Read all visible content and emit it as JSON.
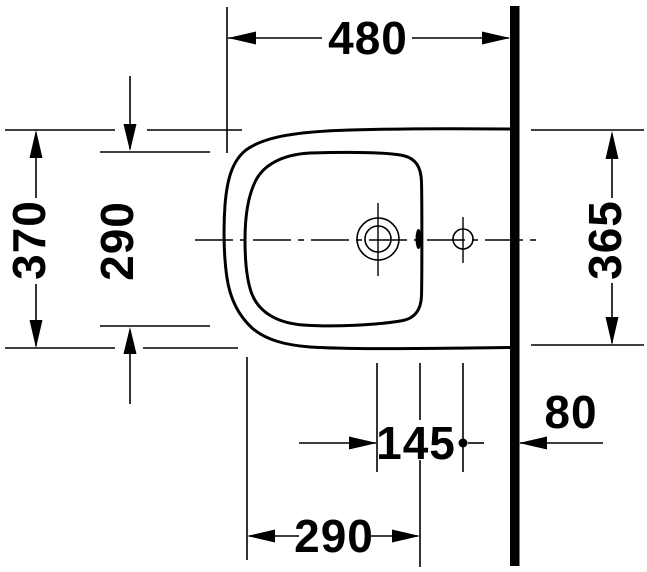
{
  "drawing": {
    "subject": "bidet top-view installation drawing",
    "background_color": "#ffffff",
    "line_color": "#000000",
    "dimensions": {
      "overall_width": "480",
      "overall_depth": "370",
      "basin_depth": "290",
      "depth_at_wall": "365",
      "tap_to_outlet": "145",
      "outlet_to_wall": "80",
      "front_to_outlet": "290"
    }
  }
}
